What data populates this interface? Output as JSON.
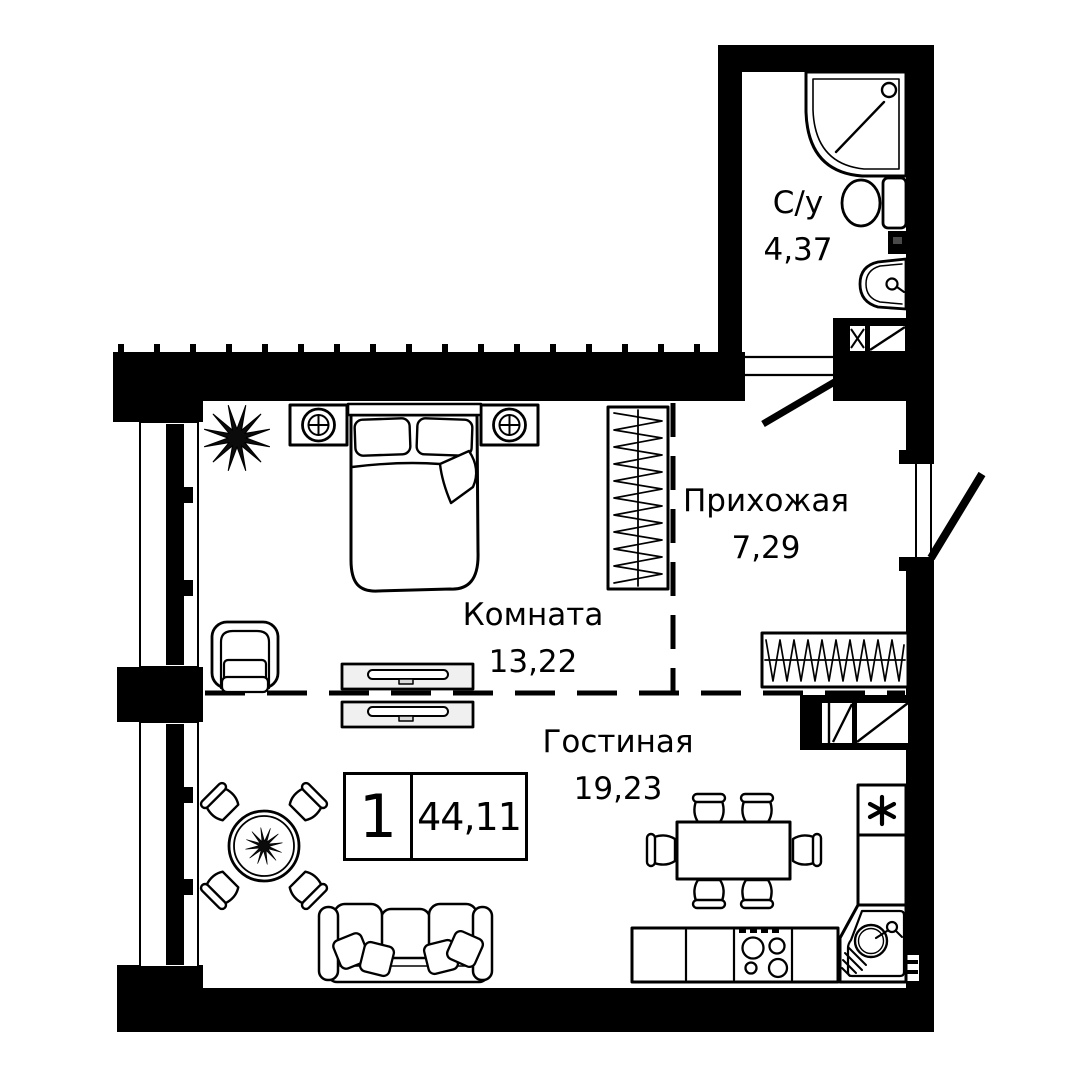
{
  "plan_type": "apartment-floor-plan",
  "rooms": [
    {
      "id": "bathroom",
      "name": "С/у",
      "area": "4,37"
    },
    {
      "id": "hallway",
      "name": "Прихожая",
      "area": "7,29"
    },
    {
      "id": "bedroom",
      "name": "Комната",
      "area": "13,22"
    },
    {
      "id": "living",
      "name": "Гостиная",
      "area": "19,23"
    }
  ],
  "badge": {
    "rooms": "1",
    "area": "44,11"
  },
  "colors": {
    "wall": "#000000",
    "background": "#ffffff",
    "line": "#000000",
    "cabinet_fill": "#f0f0f0"
  }
}
